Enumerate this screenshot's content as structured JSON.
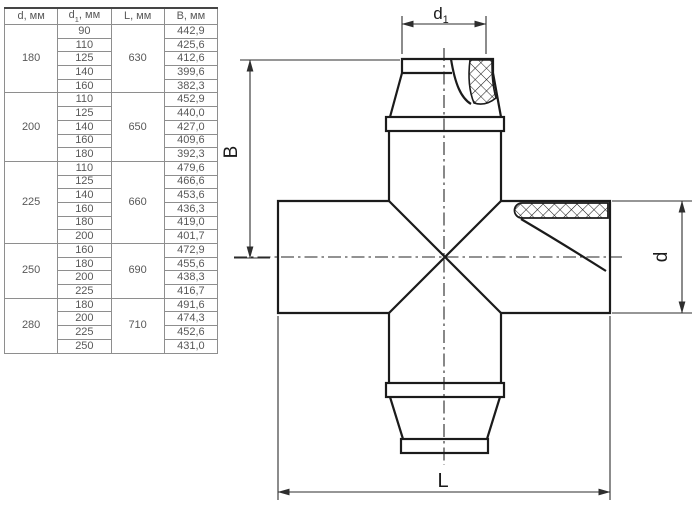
{
  "table": {
    "headers": [
      {
        "base": "d",
        "sub": "",
        "rest": ", мм"
      },
      {
        "base": "d",
        "sub": "1",
        "rest": ", мм"
      },
      {
        "base": "L",
        "sub": "",
        "rest": ", мм"
      },
      {
        "base": "B",
        "sub": "",
        "rest": ", мм"
      }
    ],
    "groups": [
      {
        "d": "180",
        "L": "630",
        "rows": [
          [
            "90",
            "442,9"
          ],
          [
            "110",
            "425,6"
          ],
          [
            "125",
            "412,6"
          ],
          [
            "140",
            "399,6"
          ],
          [
            "160",
            "382,3"
          ]
        ]
      },
      {
        "d": "200",
        "L": "650",
        "rows": [
          [
            "110",
            "452,9"
          ],
          [
            "125",
            "440,0"
          ],
          [
            "140",
            "427,0"
          ],
          [
            "160",
            "409,6"
          ],
          [
            "180",
            "392,3"
          ]
        ]
      },
      {
        "d": "225",
        "L": "660",
        "rows": [
          [
            "110",
            "479,6"
          ],
          [
            "125",
            "466,6"
          ],
          [
            "140",
            "453,6"
          ],
          [
            "160",
            "436,3"
          ],
          [
            "180",
            "419,0"
          ],
          [
            "200",
            "401,7"
          ]
        ]
      },
      {
        "d": "250",
        "L": "690",
        "rows": [
          [
            "160",
            "472,9"
          ],
          [
            "180",
            "455,6"
          ],
          [
            "200",
            "438,3"
          ],
          [
            "225",
            "416,7"
          ]
        ]
      },
      {
        "d": "280",
        "L": "710",
        "rows": [
          [
            "180",
            "491,6"
          ],
          [
            "200",
            "474,3"
          ],
          [
            "225",
            "452,6"
          ],
          [
            "250",
            "431,0"
          ]
        ]
      }
    ]
  },
  "drawing": {
    "labels": {
      "d1_base": "d",
      "d1_sub": "1",
      "B": "B",
      "d": "d",
      "L": "L"
    }
  },
  "colors": {
    "outline": "#1b1b1b",
    "dimension": "#2e2e2e",
    "table_border": "#8e8e8e",
    "table_border_outer": "#5a5a5a",
    "table_text": "#585858",
    "background": "#ffffff"
  }
}
